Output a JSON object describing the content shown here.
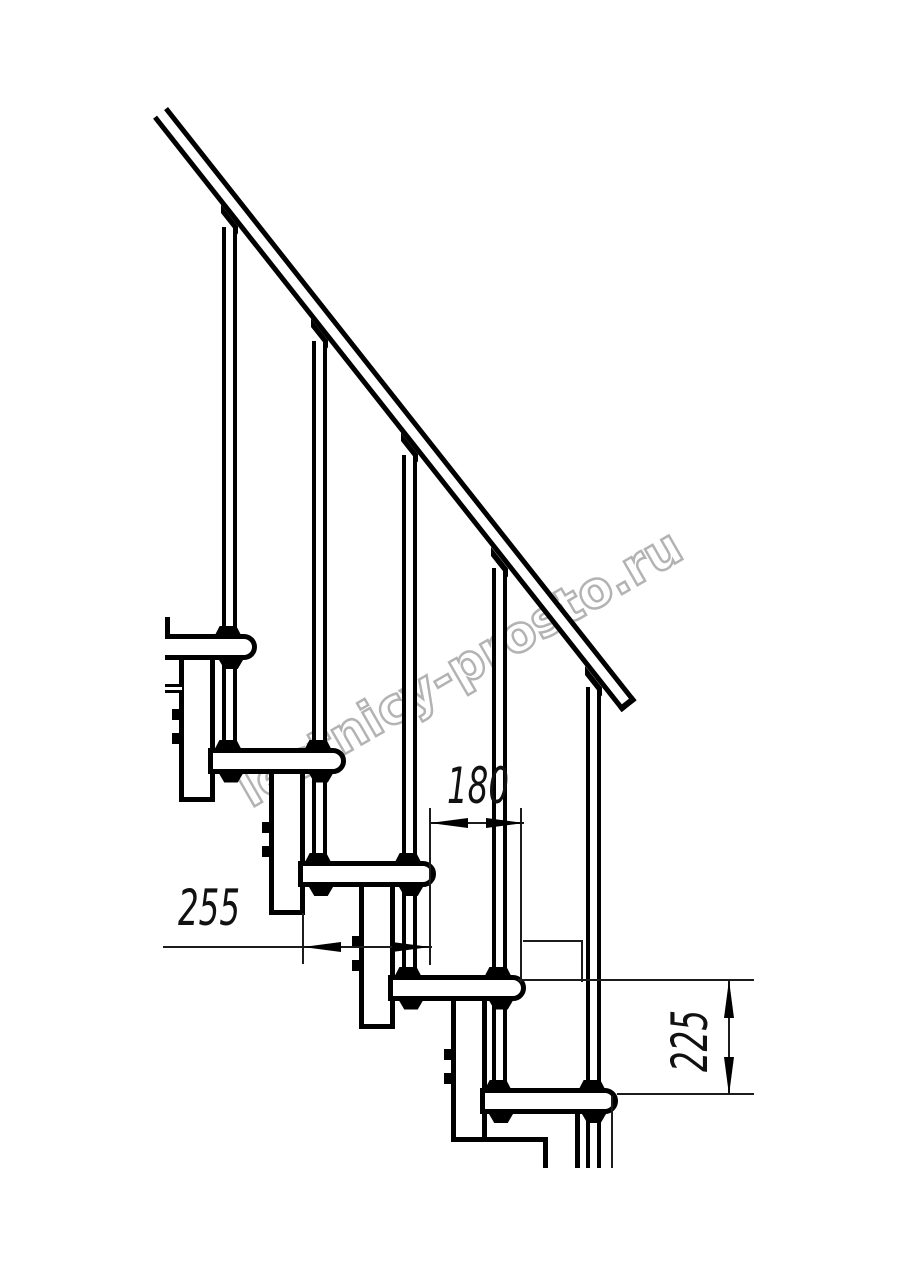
{
  "drawing": {
    "type": "technical-staircase-side-view",
    "watermark": "lestnicy-prosto.ru",
    "dimensions": {
      "run": {
        "value": "180",
        "meaning": "horizontal step run between nosings, mm"
      },
      "tread_depth": {
        "value": "255",
        "meaning": "tread board depth, mm"
      },
      "rise": {
        "value": "225",
        "meaning": "vertical rise between treads, mm"
      }
    },
    "step_count": 5,
    "baluster_count": 5,
    "colors": {
      "line": "#000000",
      "thin_line": "#1c1c1c",
      "watermark": "#b3b3b3",
      "background": "#ffffff"
    }
  }
}
